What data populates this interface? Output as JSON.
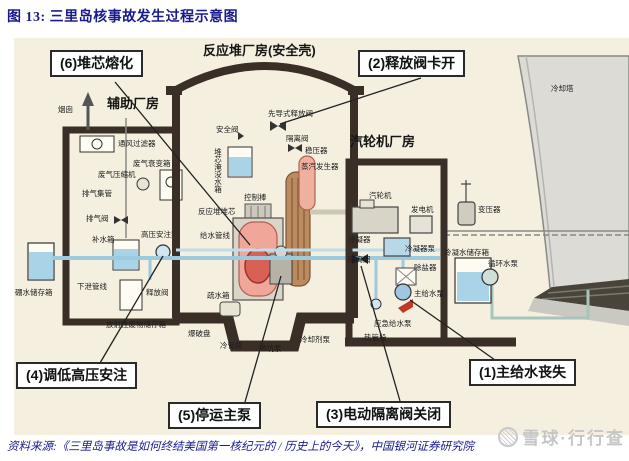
{
  "title": "图 13: 三里岛核事故发生过程示意图",
  "source": "资料来源:《三里岛事故是如何终结美国第一核纪元的 / 历史上的今天》，中国银河证券研究院",
  "watermark": "雪球·行行查",
  "colors": {
    "accent_navy": "#1a1a8e",
    "diagram_cream": "#f4efdf",
    "wall_dark": "#3a2f26",
    "water_blue": "#a9d3e6",
    "reactor_pink": "#f0a79a",
    "steam_gen_brown": "#bb8a5e",
    "tower_gray": "#dcdbd5",
    "alert_red": "#c0392b",
    "watermark_gray": "#c6c6c6"
  },
  "diagram": {
    "buildings": {
      "auxiliary": "辅助厂房",
      "reactor": "反应堆厂房(安全壳)",
      "turbine": "汽轮机厂房"
    },
    "callouts": {
      "c1": "(1)主给水丧失",
      "c2": "(2)释放阀卡开",
      "c3": "(3)电动隔离阀关闭",
      "c4": "(4)调低高压安注",
      "c5": "(5)停运主泵",
      "c6": "(6)堆芯熔化"
    },
    "labels": {
      "chimney": "烟囱",
      "vent_filter": "通风过滤器",
      "waste_gas_decay_tank": "废气衰变箱",
      "waste_gas_compressor": "废气压缩机",
      "exhaust_header": "排气集管",
      "exhaust_valve": "排气阀",
      "makeup_tank": "补水箱",
      "hp_injection_pump": "高压安注泵",
      "letdown_line": "下泄管线",
      "release_valve": "释放阀",
      "boron_tank": "硼水储存箱",
      "radwaste_tank": "放射性废物储存箱",
      "safety_valve": "安全阀",
      "pilot_relief_valve": "先导式释放阀",
      "isolation_valve_containment": "隔离阀",
      "pressurizer": "稳压器",
      "steam_generator": "蒸汽发生器",
      "core_flood_tank": "堆芯淹没水箱",
      "control_rods": "控制棒",
      "reactor_core": "反应堆堆芯",
      "feedwater_line": "给水管线",
      "drain_tank": "疏水箱",
      "rupture_disk": "爆破盘",
      "cold_leg": "冷管段",
      "sump_pump": "地坑泵",
      "coolant_pump": "冷却剂泵",
      "steam_turbine": "汽轮机",
      "generator": "发电机",
      "transformer": "变压器",
      "condenser": "冷凝器",
      "condenser_pump": "冷凝器泵",
      "demineralizer": "除盐器",
      "isolation_valve_turbine": "隔离阀",
      "condensate_tank": "冷凝水储存箱",
      "circulating_pump": "循环水泵",
      "main_feed_pump": "主给水泵",
      "emergency_feed_pump": "应急给水泵",
      "hot_leg": "热管段",
      "cooling_tower": "冷却塔"
    }
  }
}
